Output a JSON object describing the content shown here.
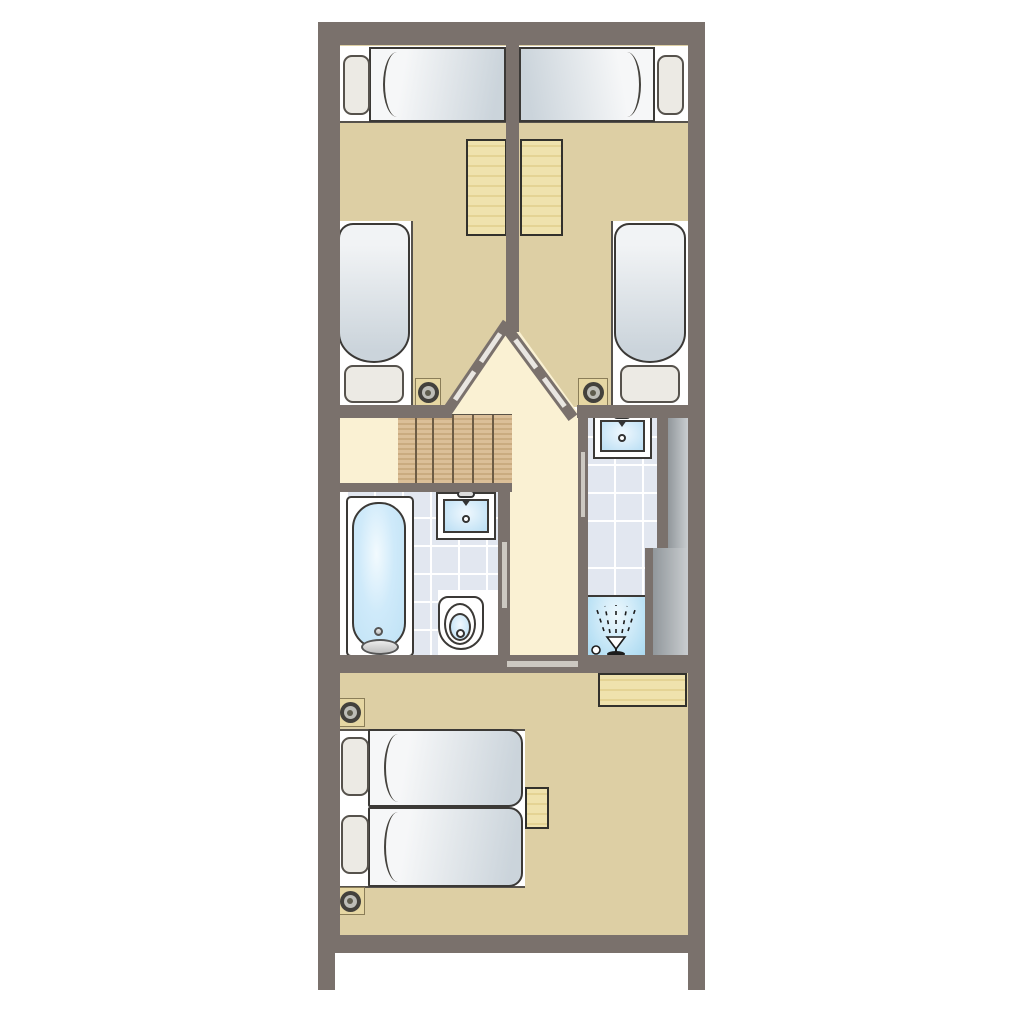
{
  "meta": {
    "kind": "architectural floor plan",
    "description": "Upper-floor plan of a narrow holiday cottage: two twin bedrooms at the top separated by a central wall with angled doors, a landing with a straight staircase, a bathroom with bathtub, washbasin and toilet, a separate shower room with washbasin and service duct, and a double bedroom at the bottom."
  },
  "labels": {
    "plan": "Cottage upper floor plan",
    "bedroom_left": "Twin bedroom (left)",
    "bedroom_right": "Twin bedroom (right)",
    "landing": "Landing",
    "staircase": "Staircase",
    "bathroom": "Bathroom",
    "shower_room": "Shower room",
    "bedroom_double": "Double bedroom",
    "single_bed_horizontal": "Single bed",
    "single_bed_vertical": "Single bed",
    "double_bed": "Double bed",
    "mattress": "Mattress",
    "pillow": "Pillow",
    "desk": "Desk",
    "sideboard": "Sideboard",
    "bedside_table": "Bedside table",
    "bathtub": "Bathtub",
    "washbasin": "Washbasin",
    "toilet": "Toilet",
    "shower": "Shower",
    "spotlight": "Ceiling spotlight",
    "door": "Door",
    "duct": "Service duct"
  },
  "inventory": {
    "single_beds": 4,
    "double_beds": 1,
    "desks": 3,
    "bedside_tables": 1,
    "staircases": 1,
    "stair_treads": 6,
    "bathtubs": 1,
    "washbasins": 2,
    "toilets": 1,
    "showers": 1,
    "ceiling_spotlights": 4,
    "doors": 5
  },
  "palette": {
    "wall": "#7a716c",
    "bedroom_floor": "#ddcfa4",
    "hall_floor": "#faf1d3",
    "tile_floor": "#e2e7f0",
    "tile_grout": "#ffffff",
    "wood_furniture": "#eee0ab",
    "wood_stairs": "#d7b88c",
    "mattress_light": "#f6f7f8",
    "mattress_shade": "#cbd4db",
    "pillow": "#eceae4",
    "water_blue": "#cfeafa",
    "shower_blue": "#bce2f5",
    "outline": "#3b3936",
    "door_marker": "#ccc8c1",
    "duct_gray": "#aeb3b7",
    "background": "#ffffff"
  },
  "icons": {
    "spray": "shower-spray-icon",
    "spotlight": "ceiling-spotlight-icon",
    "faucet": "faucet-icon",
    "drain": "drain-icon"
  }
}
